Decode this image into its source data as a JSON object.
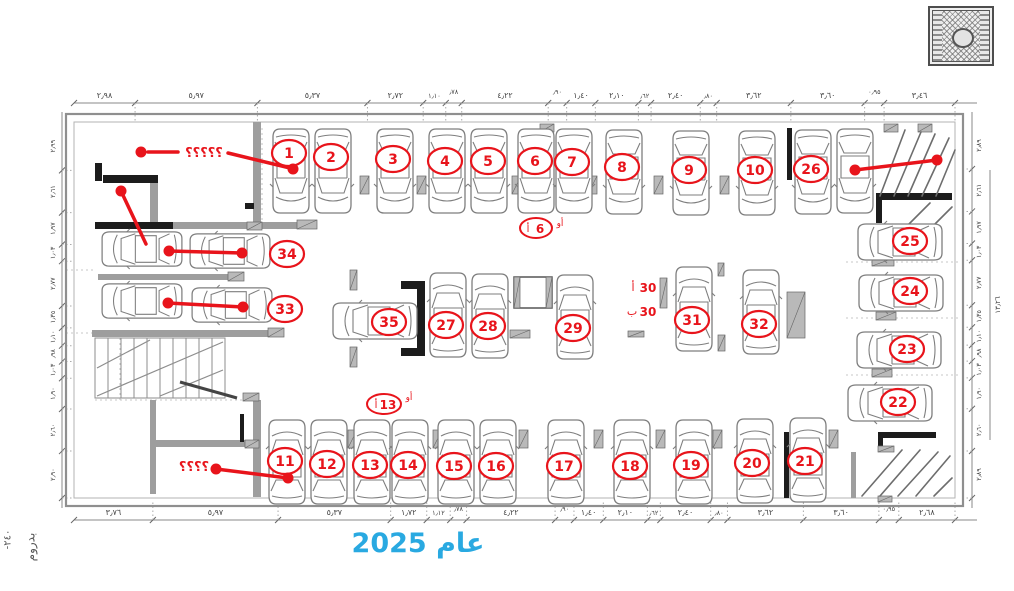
{
  "title": {
    "text": "عام 2025",
    "color": "#29a9e1"
  },
  "side_note": {
    "line1": "بدروم",
    "line2": "-٢٤٠"
  },
  "stamp": {
    "name": "ornamental-seal"
  },
  "colors": {
    "red": "#e8141b",
    "ink": "#444444",
    "wall_gray": "#9e9e9e",
    "wall_black": "#1c1c1c",
    "car_line": "#7e7e7e"
  },
  "spots": [
    {
      "n": "1",
      "cx": 291,
      "cy": 171,
      "rot": 180,
      "lx": 289,
      "ly": 153
    },
    {
      "n": "2",
      "cx": 333,
      "cy": 171,
      "rot": 180,
      "lx": 331,
      "ly": 157
    },
    {
      "n": "3",
      "cx": 395,
      "cy": 171,
      "rot": 180,
      "lx": 393,
      "ly": 159
    },
    {
      "n": "4",
      "cx": 447,
      "cy": 171,
      "rot": 180,
      "lx": 445,
      "ly": 161
    },
    {
      "n": "5",
      "cx": 489,
      "cy": 171,
      "rot": 180,
      "lx": 488,
      "ly": 161
    },
    {
      "n": "6",
      "cx": 536,
      "cy": 171,
      "rot": 180,
      "lx": 535,
      "ly": 161
    },
    {
      "n": "7",
      "cx": 574,
      "cy": 171,
      "rot": 180,
      "lx": 572,
      "ly": 162
    },
    {
      "n": "8",
      "cx": 624,
      "cy": 172,
      "rot": 180,
      "lx": 622,
      "ly": 167
    },
    {
      "n": "9",
      "cx": 691,
      "cy": 173,
      "rot": 180,
      "lx": 689,
      "ly": 170
    },
    {
      "n": "10",
      "cx": 757,
      "cy": 173,
      "rot": 180,
      "lx": 755,
      "ly": 170
    },
    {
      "n": "26",
      "cx": 813,
      "cy": 172,
      "rot": 180,
      "lx": 811,
      "ly": 169
    },
    {
      "n": "",
      "cx": 855,
      "cy": 171,
      "rot": 180
    },
    {
      "n": "25",
      "cx": 900,
      "cy": 242,
      "rot": -90,
      "lx": 910,
      "ly": 241
    },
    {
      "n": "24",
      "cx": 901,
      "cy": 293,
      "rot": -90,
      "lx": 910,
      "ly": 291
    },
    {
      "n": "23",
      "cx": 899,
      "cy": 350,
      "rot": -90,
      "lx": 907,
      "ly": 349
    },
    {
      "n": "22",
      "cx": 890,
      "cy": 403,
      "rot": -90,
      "lx": 898,
      "ly": 402
    },
    {
      "n": "34",
      "cars": [
        [
          142,
          249
        ],
        [
          230,
          251
        ]
      ],
      "rot": -90,
      "lx": 287,
      "ly": 254
    },
    {
      "n": "33",
      "cars": [
        [
          142,
          301
        ],
        [
          232,
          305
        ]
      ],
      "rot": -90,
      "lx": 285,
      "ly": 309
    },
    {
      "n": "35",
      "cx": 375,
      "cy": 321,
      "rot": -90,
      "lx": 389,
      "ly": 322
    },
    {
      "n": "27",
      "cx": 448,
      "cy": 315,
      "rot": 0,
      "lx": 446,
      "ly": 325
    },
    {
      "n": "28",
      "cx": 490,
      "cy": 316,
      "rot": 0,
      "lx": 488,
      "ly": 326
    },
    {
      "n": "29",
      "cx": 575,
      "cy": 317,
      "rot": 0,
      "lx": 573,
      "ly": 328
    },
    {
      "n": "31",
      "cx": 694,
      "cy": 309,
      "rot": 0,
      "lx": 692,
      "ly": 320
    },
    {
      "n": "32",
      "cx": 761,
      "cy": 312,
      "rot": 0,
      "lx": 759,
      "ly": 324
    },
    {
      "n": "11",
      "cx": 287,
      "cy": 462,
      "rot": 0,
      "lx": 285,
      "ly": 461
    },
    {
      "n": "12",
      "cx": 329,
      "cy": 462,
      "rot": 0,
      "lx": 327,
      "ly": 464
    },
    {
      "n": "13",
      "cx": 372,
      "cy": 462,
      "rot": 0,
      "lx": 370,
      "ly": 465
    },
    {
      "n": "14",
      "cx": 410,
      "cy": 462,
      "rot": 0,
      "lx": 408,
      "ly": 465
    },
    {
      "n": "15",
      "cx": 456,
      "cy": 462,
      "rot": 0,
      "lx": 454,
      "ly": 466
    },
    {
      "n": "16",
      "cx": 498,
      "cy": 462,
      "rot": 0,
      "lx": 496,
      "ly": 466
    },
    {
      "n": "17",
      "cx": 566,
      "cy": 462,
      "rot": 0,
      "lx": 564,
      "ly": 466
    },
    {
      "n": "18",
      "cx": 632,
      "cy": 462,
      "rot": 0,
      "lx": 630,
      "ly": 466
    },
    {
      "n": "19",
      "cx": 694,
      "cy": 462,
      "rot": 0,
      "lx": 691,
      "ly": 465
    },
    {
      "n": "20",
      "cx": 755,
      "cy": 461,
      "rot": 0,
      "lx": 752,
      "ly": 463
    },
    {
      "n": "21",
      "cx": 808,
      "cy": 460,
      "rot": 0,
      "lx": 805,
      "ly": 461
    }
  ],
  "extra_labels": [
    {
      "id": "spot-6a",
      "ellipse": [
        536,
        228,
        16,
        10
      ],
      "prefix": "أ",
      "num": "6",
      "suffix": "أو",
      "sx": 560,
      "sy": 226
    },
    {
      "id": "spot-13a",
      "ellipse": [
        384,
        404,
        17,
        10
      ],
      "prefix": "أ",
      "num": "13",
      "suffix": "أو",
      "sx": 409,
      "sy": 400
    },
    {
      "id": "spot-30a",
      "prefix": "أ",
      "num": "30",
      "px": 633,
      "py": 291,
      "nx": 648,
      "ny": 292
    },
    {
      "id": "spot-30b",
      "prefix": "ب",
      "num": "30",
      "px": 632,
      "py": 315,
      "nx": 648,
      "ny": 316
    }
  ],
  "annotations": [
    {
      "id": "unknown-room-top",
      "text": "؟؟؟؟؟",
      "tx": 204,
      "ty": 157,
      "dots": [
        [
          141,
          152
        ],
        [
          293,
          169
        ]
      ],
      "lines": [
        [
          148,
          152,
          178,
          152
        ],
        [
          228,
          153,
          290,
          168
        ]
      ]
    },
    {
      "id": "partition-pointer",
      "dots": [
        [
          121,
          191
        ]
      ],
      "lines": [
        [
          121,
          191,
          146,
          244
        ]
      ]
    },
    {
      "id": "tandem-34",
      "dots": [
        [
          169,
          251
        ],
        [
          242,
          253
        ]
      ],
      "lines": [
        [
          169,
          251,
          242,
          253
        ]
      ]
    },
    {
      "id": "tandem-33",
      "dots": [
        [
          168,
          303
        ],
        [
          243,
          307
        ]
      ],
      "lines": [
        [
          168,
          303,
          243,
          307
        ]
      ]
    },
    {
      "id": "ramp-top-right",
      "dots": [
        [
          855,
          170
        ],
        [
          937,
          160
        ]
      ],
      "lines": [
        [
          855,
          170,
          937,
          160
        ]
      ]
    },
    {
      "id": "unknown-room-bottom",
      "text": "؟؟؟؟",
      "tx": 194,
      "ty": 471,
      "dots": [
        [
          216,
          469
        ],
        [
          288,
          478
        ]
      ],
      "lines": [
        [
          216,
          469,
          288,
          478
        ]
      ]
    }
  ],
  "dims": {
    "top": {
      "labels": [
        "٢٫٩٨",
        "٥٫٩٧",
        "٥٫٣٧",
        "٢٫٧٢",
        "١٫١٠",
        "٫٧٨",
        "٤٫٢٢",
        "٫٩٠",
        "١٫٤٠",
        "٢٫١٠",
        "٫٦٢",
        "٢٫٤٠",
        "٫٨٠",
        "٣٫٦٢",
        "٣٫٦٠",
        "٠٫٩٥",
        "٣٫٤٦"
      ],
      "meters": [
        2.98,
        5.97,
        5.37,
        2.72,
        1.1,
        0.78,
        4.22,
        0.9,
        1.4,
        2.1,
        0.62,
        2.4,
        0.8,
        3.62,
        3.6,
        0.95,
        3.46
      ]
    },
    "bottom": {
      "labels": [
        "٣٫٧٦",
        "٥٫٩٧",
        "٥٫٣٧",
        "١٫٧٢",
        "١٫١٢",
        "٫٧٨",
        "٤٫٢٢",
        "٫٩٠",
        "١٫٤٠",
        "٢٫١٠",
        "٫٦٢",
        "٢٫٤٠",
        "٫٨٠",
        "٣٫٦٢",
        "٣٫٦٠",
        "٠٫٩٥",
        "٢٫٦٨"
      ],
      "meters": [
        3.76,
        5.97,
        5.37,
        1.72,
        1.12,
        0.78,
        4.22,
        0.9,
        1.4,
        2.1,
        0.62,
        2.4,
        0.8,
        3.62,
        3.6,
        0.95,
        2.68
      ]
    },
    "left": {
      "labels": [
        "٢٫٩٩",
        "٢٫٦١",
        "١٫٩٧",
        "١٫٠٣",
        "٢٫٧٧",
        "١٫٣٥",
        "١٫١٠",
        "٫٩٨",
        "١٫٠٣",
        "١٫٩٠",
        "٢٫٦٠",
        "٢٫٩٠"
      ],
      "meters": [
        2.99,
        2.61,
        1.97,
        1.03,
        2.77,
        1.35,
        1.1,
        0.98,
        1.03,
        1.9,
        2.6,
        2.9
      ]
    },
    "right": {
      "labels": [
        "٢٫٨٩",
        "٢٫٦١",
        "١٫٩٧",
        "١٫٠٣",
        "٢٫٧٧",
        "١٫٣٥",
        "١٫١٠",
        "٫٩٨",
        "١٫٠٣",
        "١٫٩٠",
        "٢٫٦٠",
        "٢٫٨٩"
      ],
      "meters": [
        2.89,
        2.61,
        1.97,
        1.03,
        2.77,
        1.35,
        1.1,
        0.98,
        1.03,
        1.9,
        2.6,
        2.89
      ]
    },
    "right_outer": "١٣٫٢٦"
  }
}
